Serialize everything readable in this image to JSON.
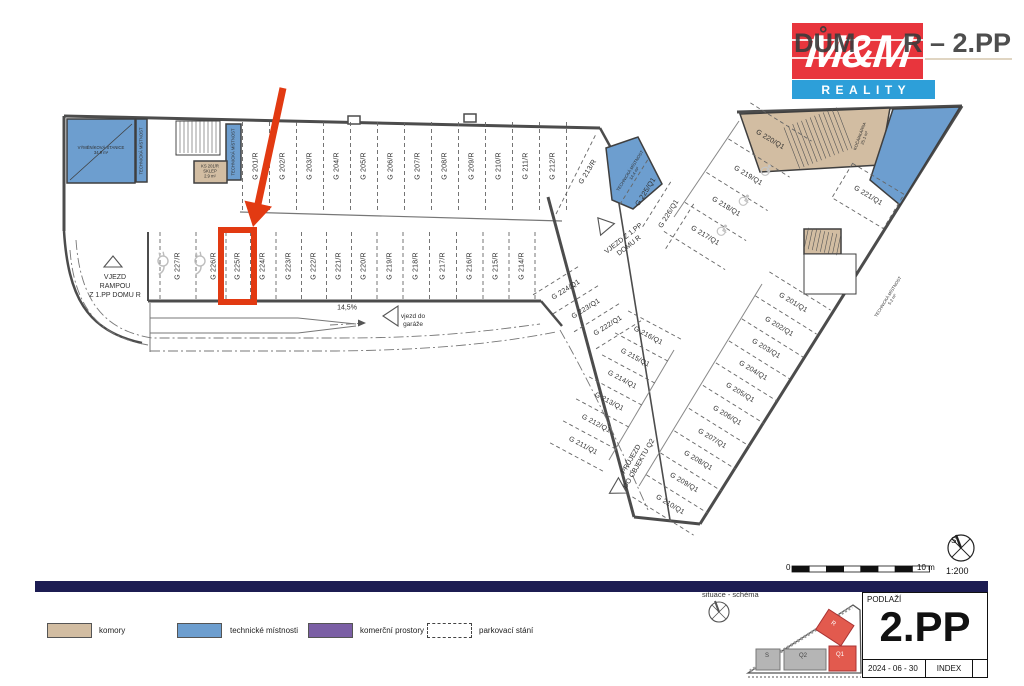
{
  "header": {
    "title_left": "DŮM",
    "title_right": "R – 2.PP",
    "logo_top": "M&M",
    "logo_bottom": "REALITY"
  },
  "colors": {
    "accent_red": "#e23a12",
    "logo_red": "#e8353d",
    "logo_blue": "#2d9fd9",
    "navy_bar": "#1c1c52",
    "komory_tan": "#d2bda2",
    "technicke_blue": "#6d9ecf",
    "komercni_purple": "#7b5fa5"
  },
  "plan": {
    "highlight_stall": "G 225/R",
    "stalls": {
      "r_top": [
        "G 201/R",
        "G 202/R",
        "G 203/R",
        "G 204/R",
        "G 205/R",
        "G 206/R",
        "G 207/R",
        "G 208/R",
        "G 209/R",
        "G 210/R",
        "G 211/R",
        "G 212/R"
      ],
      "r_mid": [
        "G 227/R",
        "G 226/R",
        "G 225/R",
        "G 224/R",
        "G 223/R",
        "G 222/R",
        "G 221/R",
        "G 220/R",
        "G 219/R",
        "G 218/R",
        "G 217/R",
        "G 216/R",
        "G 215/R",
        "G 214/R"
      ],
      "q1_upper": [
        "G 225/Q1",
        "G 226/Q1"
      ],
      "q1_connector": [
        "G 224/Q1",
        "G 223/Q1",
        "G 222/Q1"
      ],
      "q1_inner": [
        "G 216/Q1",
        "G 215/Q1",
        "G 214/Q1",
        "G 213/Q1",
        "G 212/Q1",
        "G 211/Q1"
      ],
      "q1_outer_top": [
        "G 220/Q1",
        "G 219/Q1",
        "G 218/Q1",
        "G 217/Q1"
      ],
      "q1_outer_bottom": [
        "G 201/Q1",
        "G 202/Q1",
        "G 203/Q1",
        "G 204/Q1",
        "G 205/Q1",
        "G 206/Q1",
        "G 207/Q1",
        "G 208/Q1",
        "G 209/Q1",
        "G 210/Q1"
      ]
    },
    "single_stalls": {
      "r_diag": "G 213/R",
      "q1_221": "G 221/Q1"
    },
    "texts": {
      "vjezd_rampou": "VJEZD\nRAMPOU\nZ 1.PP DOMU R",
      "vjezd_z1pp": "VJEZD Z 1.PP\nDOMU R",
      "prujezd": "PRŮJEZD\nDO OBJEKTU Q2",
      "vjezd_garaz": "vjezd do\ngaráže",
      "slope": "14,5%",
      "sklep": "KS 201/R\nSKLEP\n2.9 m²",
      "vymenik": "VÝMĚNÍKOVÁ STANICE\n34.9 m²",
      "tech_strip_left": "TECHNICKÁ MÍSTNOST",
      "tech_strip_right": "TECHNICKÁ MÍSTNOST",
      "tech_conn": "TECHNICKÁ MÍSTNOST\n14.4 m²",
      "kocarkarna": "KOČÁRKÁRNA\n25.1 m²",
      "tech_edge": "TECHNICKÁ MÍSTNOST\n5.2 m²"
    }
  },
  "legend": {
    "items": [
      {
        "label": "komory",
        "color": "#d2bda2"
      },
      {
        "label": "technické místnosti",
        "color": "#6d9ecf"
      },
      {
        "label": "komerční prostory",
        "color": "#7b5fa5"
      },
      {
        "label": "parkovací stání",
        "color": "dashed"
      }
    ]
  },
  "scalebar": {
    "zero": "0",
    "max": "10 m",
    "ratio": "1:200",
    "north": "S"
  },
  "titleblock": {
    "label": "PODLAŽÍ",
    "floor": "2.PP",
    "date": "2024 - 06 - 30",
    "index": "INDEX"
  },
  "minimap": {
    "caption": "situace - schéma",
    "s": "S",
    "q2": "Q2",
    "q1": "Q1",
    "r": "R"
  }
}
